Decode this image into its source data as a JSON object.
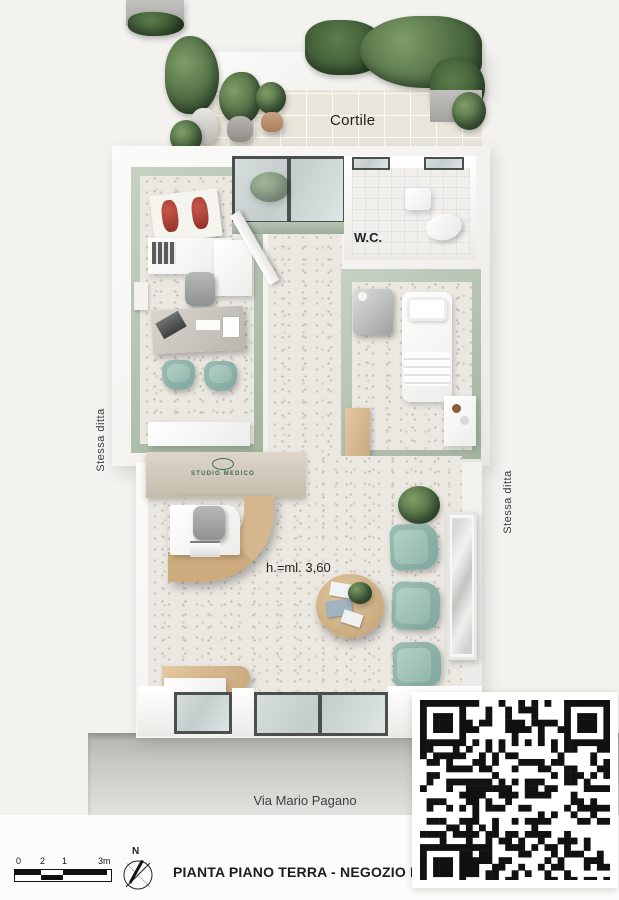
{
  "labels": {
    "courtyard": "Cortile",
    "wc": "W.C.",
    "side_left": "Stessa ditta",
    "side_right": "Stessa ditta",
    "height_note": "h.=ml. 3,60",
    "street": "Via Mario Pagano",
    "logo": "STUDIO MEDICO",
    "compass_north": "N"
  },
  "title_block": {
    "title": "PIANTA PIANO TERRA - NEGOZIO N. 3"
  },
  "scale_bar": {
    "ticks": [
      "0",
      "2",
      "1",
      "3m"
    ]
  },
  "colors": {
    "sage_wall": "#b4c2b1",
    "teal_chair": "#8fb3aa",
    "wood": "#d5b78d",
    "terrazzo_floor": "#ebe8e2",
    "courtyard_tile": "#e9e5da",
    "sidewalk": "#c6c5c1",
    "logo_green": "#3c6b52",
    "qr_black": "#111111"
  }
}
